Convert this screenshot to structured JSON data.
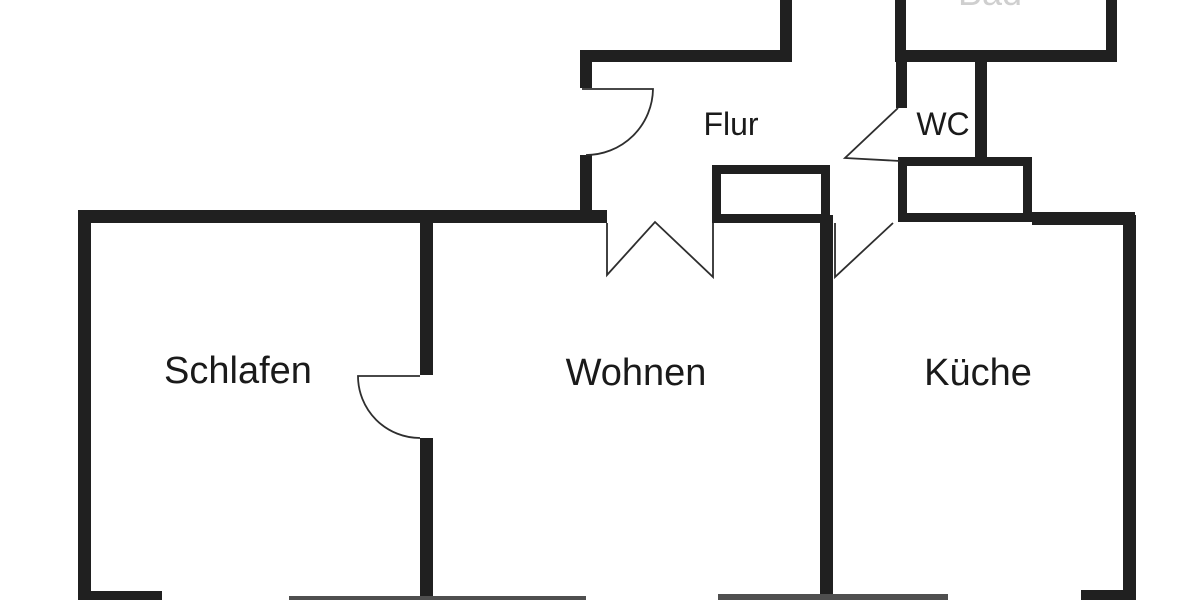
{
  "plan": {
    "type": "apartment-floor-plan",
    "rooms": {
      "schlafen": {
        "label": "Schlafen"
      },
      "wohnen": {
        "label": "Wohnen"
      },
      "kueche": {
        "label": "Küche"
      },
      "flur": {
        "label": "Flur"
      },
      "wc": {
        "label": "WC"
      },
      "bad": {
        "label": "Bad"
      }
    }
  },
  "colors": {
    "background": "#ffffff",
    "wall": "#202020",
    "wall_thin": "#4f4f4f",
    "door_line": "#2e2e2e",
    "text": "#1a1a1a",
    "faint_text": "#cfcfcf",
    "room_fill": "#ffffff"
  }
}
